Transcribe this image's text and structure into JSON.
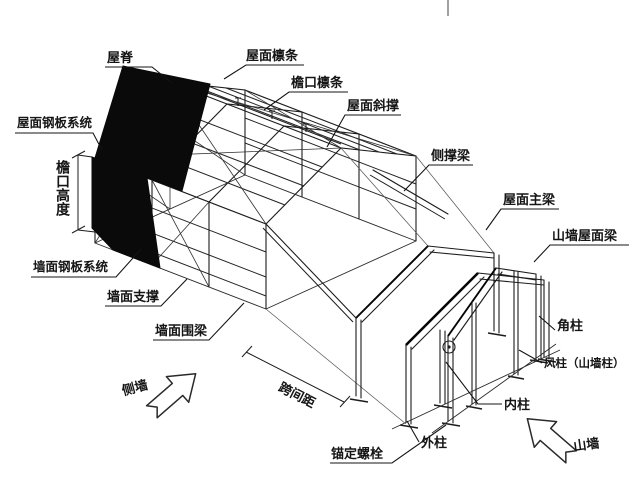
{
  "diagram": {
    "subject": "steel-structure-building-annotated-diagram",
    "labels": {
      "ridge": "屋脊",
      "roof_purlin": "屋面檩条",
      "eave_purlin": "檐口檩条",
      "roof_brace": "屋面斜撑",
      "side_support_beam": "侧撑梁",
      "roof_main_beam": "屋面主梁",
      "gable_roof_beam": "山墙屋面梁",
      "roof_panel_system": "屋面钢板系统",
      "eave_height": "檐口高度",
      "wall_panel_system": "墙面钢板系统",
      "wall_brace": "墙面支撑",
      "wall_girt": "墙面围梁",
      "corner_column": "角柱",
      "wind_column": "风柱（山墙柱）",
      "inner_column": "内柱",
      "outer_column": "外柱",
      "anchor_bolt": "锚定螺栓",
      "bay_spacing": "跨间距",
      "side_wall": "侧墙",
      "gable_wall": "山墙"
    },
    "colors": {
      "line": "#1c1c1c",
      "panel": "#0a0a0a",
      "background": "#ffffff",
      "divider": "#888888"
    }
  }
}
